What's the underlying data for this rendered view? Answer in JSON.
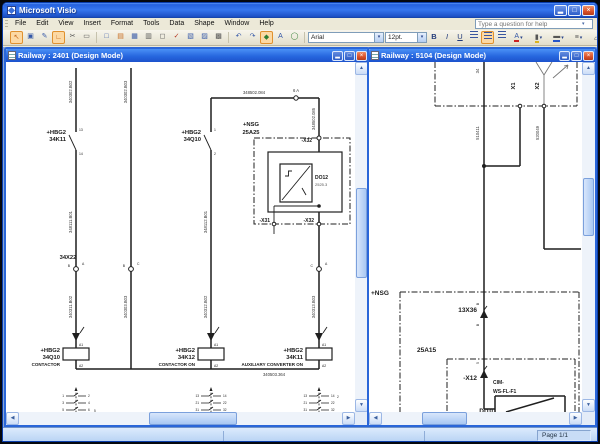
{
  "app": {
    "title": "Microsoft Visio",
    "help_placeholder": "Type a question for help",
    "window_buttons": {
      "minimize": "▂",
      "maximize": "□",
      "close": "×"
    }
  },
  "menu": {
    "items": [
      "File",
      "Edit",
      "View",
      "Insert",
      "Format",
      "Tools",
      "Data",
      "Shape",
      "Window",
      "Help"
    ]
  },
  "toolbar": {
    "font_name": "Arial",
    "font_size": "12pt.",
    "bold": "B",
    "italic": "I",
    "underline": "U",
    "dropdown_arrow": "▾",
    "icons": [
      {
        "name": "pointer-tool-icon",
        "glyph": "↖"
      },
      {
        "name": "stencil-icon",
        "glyph": "▣"
      },
      {
        "name": "pen-icon",
        "glyph": "✎"
      },
      {
        "name": "connector-tool-icon",
        "glyph": "∟"
      },
      {
        "name": "cut-icon",
        "glyph": "✂"
      },
      {
        "name": "eraser-icon",
        "glyph": "▭"
      },
      {
        "name": "new-document-icon",
        "glyph": "□"
      },
      {
        "name": "open-icon",
        "glyph": "▤"
      },
      {
        "name": "save-icon",
        "glyph": "▦"
      },
      {
        "name": "print-icon",
        "glyph": "▥"
      },
      {
        "name": "print-preview-icon",
        "glyph": "◻"
      },
      {
        "name": "spelling-icon",
        "glyph": "✓"
      },
      {
        "name": "copy-icon",
        "glyph": "▧"
      },
      {
        "name": "paste-icon",
        "glyph": "▨"
      },
      {
        "name": "format-painter-icon",
        "glyph": "▩"
      },
      {
        "name": "undo-icon",
        "glyph": "↶"
      },
      {
        "name": "redo-icon",
        "glyph": "↷"
      },
      {
        "name": "ink-tool-icon",
        "glyph": "◆"
      },
      {
        "name": "text-tool-icon",
        "glyph": "A"
      },
      {
        "name": "zoom-icon",
        "glyph": "◯"
      }
    ],
    "color_buttons": [
      {
        "name": "text-color-icon",
        "glyph": "A"
      },
      {
        "name": "fill-color-icon",
        "glyph": "▮"
      },
      {
        "name": "line-color-icon",
        "glyph": "▬"
      },
      {
        "name": "line-weight-icon",
        "glyph": "≡"
      },
      {
        "name": "shadow-icon",
        "glyph": "▱"
      }
    ]
  },
  "left_window": {
    "title": "Railway : 2401 (Design Mode)",
    "diagram": {
      "top_wire_label": "348502.084",
      "top_pin": "6  A",
      "w1_top": "340302.B02",
      "w2_top": "340302.B03",
      "w4_top": "348502.085",
      "w1_mid": "348111.B01",
      "w3_mid": "348112.B01",
      "w1_low": "340311.B02",
      "w2_low": "340303.B03",
      "w3_low": "340312.B02",
      "w4_low": "340313.B03",
      "rail_label": "340503.364",
      "k11": {
        "l1": "+HBG2",
        "l2": "34K11",
        "pin_top": "13",
        "pin_bot": "14"
      },
      "q10": {
        "l1": "+HBG2",
        "l2": "34Q10",
        "pin_top": "1",
        "pin_bot": "2"
      },
      "nsg": {
        "l1": "+NSG",
        "l2": "25A25"
      },
      "x32_top": "-X32",
      "do12": {
        "l1": "DO12",
        "l2": "2525.3"
      },
      "x31_bot": "-X31",
      "x32_bot": "-X32",
      "x22": "34X22",
      "conn1": {
        "left": "B",
        "right": "A"
      },
      "conn2": {
        "left": "B",
        "right": "C"
      },
      "conn3": {
        "left": "C",
        "right": "A"
      },
      "coil1": {
        "l1": "+HBG2",
        "l2": "34Q10",
        "l3": "CONTACTOR",
        "pin_top": "A1",
        "pin_bot": "A2"
      },
      "coil2": {
        "l1": "+HBG2",
        "l2": "34K12",
        "l3": "CONTACTOR ON",
        "pin_top": "A1",
        "pin_bot": "A2"
      },
      "coil3": {
        "l1": "+HBG2",
        "l2": "34K11",
        "l3": "AUXILIARY CONVERTER ON",
        "pin_top": "A1",
        "pin_bot": "A2"
      },
      "xref1": {
        "rows": [
          [
            "1",
            "2"
          ],
          [
            "3",
            "4"
          ],
          [
            "5",
            "6"
          ]
        ],
        "note": "5"
      },
      "xref2": {
        "rows": [
          [
            "13",
            "14"
          ],
          [
            "21",
            "22"
          ],
          [
            "31",
            "32"
          ]
        ],
        "note": ""
      },
      "xref3": {
        "rows": [
          [
            "13",
            "14"
          ],
          [
            "21",
            "22"
          ],
          [
            "31",
            "32"
          ]
        ],
        "note": "2"
      }
    }
  },
  "right_window": {
    "title": "Railway : 5104 (Design Mode)",
    "diagram": {
      "pin_34": "34",
      "x1": "X1",
      "x2": "X2",
      "w_main": "510411",
      "w_x2": "520049",
      "nsg": "+NSG",
      "conn_13x36": "13X36",
      "pin_b_top": "B",
      "pin_b_bot": "B",
      "a15": "25A15",
      "x12": "-X12",
      "x12_pin": "5",
      "cim1": "CIM-",
      "cim2": "WS-FL-F1",
      "di10": "DI10"
    }
  },
  "status": {
    "page": "Page 1/1"
  }
}
